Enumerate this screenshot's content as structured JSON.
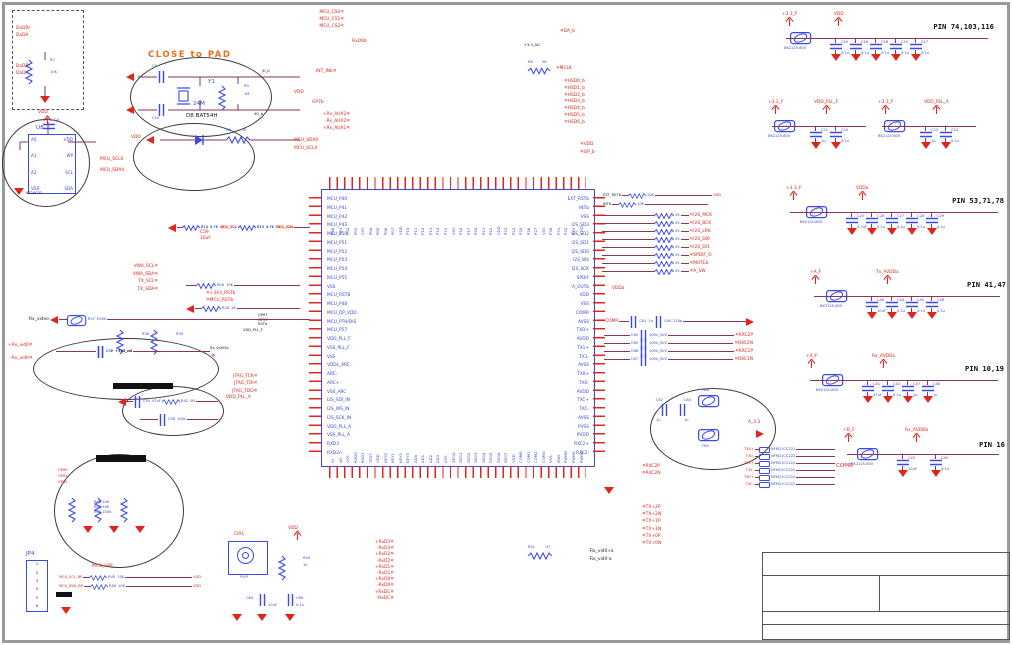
{
  "crystal_note": "CLOSE to PAD",
  "dashed_box": {
    "l1": "DaDR/",
    "l2": "DaDA",
    "l3": "DaDR/",
    "l4": "DaDA",
    "r_ref": "R7",
    "r_val": "10K"
  },
  "eeprom": {
    "ref": "U8",
    "part": "AT24C02",
    "vdd": "VDD",
    "cap_ref": "C4",
    "pins_left": [
      "A0",
      "A1",
      "A2",
      "VSS"
    ],
    "pins_right": [
      "VDD",
      "WP",
      "SCL",
      "SDA"
    ],
    "net1": "MCU_SCL0",
    "net2": "MCU_SDA0"
  },
  "crystal": {
    "ref": "Y1",
    "val": "24M",
    "c1": "C9",
    "c2": "C10",
    "r_ref": "R9",
    "r_val": "1M",
    "net_top": "XI_b",
    "net_bot": "XO_b"
  },
  "diode": {
    "label": "D8  BAT54H",
    "vdd": "VDD",
    "r_ref": "R8",
    "r_val": "1K"
  },
  "pullups": {
    "vdd": "VDD",
    "rows": [
      {
        "r1": "R12",
        "v1": "4.7K",
        "n1": "MCU_SCL",
        "r2": "R13",
        "v2": "4.7K",
        "n2": "MCU_SDA"
      },
      {
        "r1": "R14",
        "v1": "4.7K",
        "n1": "DDC_SCL",
        "r2": "R15",
        "v2": "4.7K",
        "n2": "DDC_SDA"
      }
    ]
  },
  "i2c_nets": [
    "VWA_SCL",
    "VWA_SDA",
    "TX_SCL",
    "TX_SDA"
  ],
  "c59": {
    "ref": "C59",
    "val": "10uF"
  },
  "reset": {
    "r26": "R26",
    "r26v": "10K",
    "net1": "+3V3_RSTb",
    "net2": "MCU_RSTb",
    "r28": "R28",
    "r28v": "1K",
    "gps": [
      "GP67",
      "GP57",
      "RSTb"
    ]
  },
  "pll": {
    "f": "VDD_PLL_F",
    "vid": "Rx_vid0Sa",
    "jtag": [
      "JTAG_TCK",
      "JTAG_TDI",
      "JTAG_TDO"
    ],
    "a": "VDD_PLL_A"
  },
  "left_pair": [
    "Rx_vid0+",
    "Rx_vid0-"
  ],
  "video_in": {
    "title": "Rx_video",
    "r_ref": "R37",
    "bead_val": "E560",
    "rows": [
      {
        "c": "C38",
        "net": "+3V3_vid"
      },
      {
        "c": "C37",
        "net": "+3V3_vid"
      }
    ],
    "r1": "R38",
    "r1v": "620",
    "r2": "R39",
    "r2v": "620"
  },
  "rc": {
    "c1": "C54",
    "c1v": "47uF",
    "r": "R42",
    "rv": "0R",
    "c2": "C58",
    "c2v": "100n"
  },
  "keys": {
    "nets": [
      "GP60",
      "GP61",
      "GP62"
    ],
    "res": [
      {
        "r": "R48",
        "v": "10K"
      },
      {
        "r": "R49",
        "v": "10K"
      },
      {
        "r": "R50",
        "v": "100K"
      }
    ]
  },
  "jp4": {
    "ref": "JP4",
    "pins": [
      "1",
      "2",
      "3",
      "4",
      "5",
      "6"
    ],
    "n0": "MCU_VPP",
    "n1": "MCU_SCL_BP",
    "n2": "MCU_SDA_BP",
    "r1": "R45",
    "r1v": "10K",
    "r2": "R46",
    "r2v": "10K",
    "vdd1": "VDD",
    "vdd2": "VDD"
  },
  "cir": {
    "ref": "CIR1",
    "sub": "PWR",
    "r_ref": "R40",
    "r_val": "1K",
    "vdd": "VDD",
    "c1": "C84",
    "c1v": "10uF",
    "c2": "C88",
    "c2v": "0.1u"
  },
  "ic": {
    "left_pins": [
      "MCU_P40",
      "MCU_P41",
      "MCU_P42",
      "MCU_P43",
      "MCU_P50",
      "MCU_P51",
      "MCU_P52",
      "MCU_P53",
      "MCU_P54",
      "MCU_P55",
      "VSS",
      "MCU_RSTB",
      "MCU_P48",
      "MCU_DP_VDD",
      "MCU_PTH/DIS",
      "MCU_P57",
      "VDD_PLL_F",
      "VSS_PLL_F",
      "VSS",
      "VDDL_ARC",
      "ARC-",
      "ARC+",
      "VSS_ARC",
      "I2S_SDI_IN",
      "I2S_WS_IN",
      "I2S_SCK_IN",
      "VDD_PLL_A",
      "VSS_PLL_A",
      "RXD3",
      "RXD2n"
    ],
    "right_pins": [
      "EXT_RSTb",
      "INTb",
      "VSS",
      "I2S_SD3",
      "I2S_SD2",
      "I2S_SD1",
      "I2S_SD0",
      "I2S_WS",
      "I2S_SCK",
      "SPDIF",
      "A_OUTb",
      "VDD",
      "VSS",
      "COMR",
      "AVSS",
      "TXD+",
      "AVDD",
      "TX1+",
      "TX1-",
      "AVSS",
      "TX0+",
      "TX0-",
      "AVDD",
      "TXC+",
      "TXC-",
      "AVSS",
      "PVSS",
      "PVDD",
      "RXC2+",
      "RXC2-"
    ],
    "top_pins": [
      "P00",
      "P01",
      "P02",
      "P03",
      "VSS",
      "P04",
      "P05",
      "P06",
      "P07",
      "VDD",
      "P10",
      "P11",
      "P12",
      "P13",
      "P14",
      "P15",
      "VSS",
      "P16",
      "P17",
      "P20",
      "P21",
      "P22",
      "VDD",
      "P23",
      "P24",
      "P25",
      "P26",
      "P27",
      "VSS",
      "P30",
      "P31",
      "P32",
      "P33",
      "VDD"
    ],
    "bottom_pins": [
      "XI",
      "XO",
      "VSS",
      "RXD0",
      "RXD1",
      "TEST",
      "VDD",
      "KEY0",
      "KEY1",
      "KEY2",
      "KEY3",
      "AD0",
      "AD1",
      "AD2",
      "AD3",
      "VSS",
      "SEG0",
      "SEG1",
      "SEG2",
      "SEG3",
      "SEG4",
      "SEG5",
      "SEG6",
      "SEG7",
      "VDD",
      "COM0",
      "COM1",
      "COM2",
      "COM3",
      "VSS",
      "IRIN",
      "PWM0",
      "PWM1",
      "PWM2"
    ]
  },
  "top_left_nets": [
    "MCU_CS0",
    "MCU_CS1",
    "MCU_CS2"
  ],
  "top_misc": {
    "rxd": "RxD0b",
    "int": "INT_INb",
    "vdd": "VDD",
    "gp": "GP7b",
    "ad": "+3.3_AD"
  },
  "top_aux": [
    "Rx_AUX2+",
    "Rx_AUX2-",
    "Rx_AUX1+"
  ],
  "top_i2c": [
    "MCU_SDA0",
    "MCU_SCL0"
  ],
  "top_right": {
    "da": "DA_b",
    "r6": "R6",
    "r6v": "56",
    "mclk": "MCLK",
    "hsd": [
      "HSD0_b",
      "HSD1_b",
      "HSD2_b",
      "HSD3_b",
      "HSD4_b",
      "HSD5_b",
      "HSD6_b"
    ],
    "vdd": "VDD",
    "gp": "GP_b"
  },
  "right_block": {
    "rst": {
      "n1": "EXT_RSTb",
      "r1": "R16",
      "v1": "10K",
      "n2": "INTb",
      "r2": "R17",
      "v2": "10K",
      "vdd": "VDD"
    },
    "rows": [
      {
        "r": "R18",
        "v": "33",
        "net": "I2S_MCK"
      },
      {
        "r": "R19",
        "v": "33",
        "net": "I2S_BCK"
      },
      {
        "r": "R20",
        "v": "33",
        "net": "I2S_LRK"
      },
      {
        "r": "R21",
        "v": "33",
        "net": "I2S_DI0"
      },
      {
        "r": "R22",
        "v": "33",
        "net": "I2S_DI1"
      },
      {
        "r": "R23",
        "v": "33",
        "net": "SPDIF_O"
      },
      {
        "r": "R24",
        "v": "33",
        "net": "MUTEb"
      },
      {
        "r": "R25",
        "v": "33",
        "net": "A_SW"
      }
    ],
    "vdda": "VDDa",
    "comr_row": {
      "net": "COMR",
      "c1": "C61",
      "c1v": "1u",
      "c2": "C60",
      "c2v": "220p"
    },
    "cap_rows": [
      {
        "c": "C64",
        "v": "100n_2kV",
        "net": "RXC2P"
      },
      {
        "c": "C65",
        "v": "100n_2kV",
        "net": "RXC2N"
      },
      {
        "c": "C66",
        "v": "100n_2kV",
        "net": "RXC1P"
      },
      {
        "c": "C67",
        "v": "100n_2kV",
        "net": "RXC1N"
      }
    ],
    "bead_ellipse": {
      "c1": "C62",
      "c1v": "1u",
      "c2": "C63",
      "c2v": "1u",
      "f1": "FB8",
      "f2": "FB9",
      "net": "A_3.3"
    },
    "emi": {
      "comr": "COMR",
      "rows": [
        {
          "net": "TX0+",
          "v": "NFM21CC222"
        },
        {
          "net": "TX0-",
          "v": "NFM21CC222"
        },
        {
          "net": "TX1+",
          "v": "NFM21CC222"
        },
        {
          "net": "TX1-",
          "v": "NFM21CC222"
        },
        {
          "net": "TXC+",
          "v": "NFM21CC222"
        },
        {
          "net": "TXC-",
          "v": "NFM21CC222"
        }
      ]
    }
  },
  "bottom": {
    "colA": [
      "RxD3+",
      "RxD3-",
      "RxD2+",
      "RxD2-",
      "RxD1+",
      "RxD1-",
      "RxD0+",
      "RxD0-",
      "RxDC+",
      "RxDC-"
    ],
    "pairB": [
      "RXC2P",
      "RXC2N"
    ],
    "colC": [
      "TX+2P",
      "TX+2N",
      "TX+1P",
      "TX+1N",
      "TX+0P",
      "TX+0N"
    ],
    "black_pair": [
      "Rx_vid0+a",
      "Rx_vid0-a"
    ],
    "r41": "R41",
    "r41v": "47"
  },
  "filters": [
    {
      "net1": "+3.3_F",
      "net2": "VDD",
      "pins": "PIN 74,103,116",
      "bead": "BK2125-600",
      "caps": [
        {
          "r": "C15",
          "v": "0.1u"
        },
        {
          "r": "C16",
          "v": "0.1u"
        },
        {
          "r": "C18",
          "v": "0.1u"
        },
        {
          "r": "C19",
          "v": "0.1u"
        },
        {
          "r": "C17",
          "v": "0.1u"
        }
      ]
    },
    {
      "net1": "+3.3_F",
      "net2": "VDD_PLL_F",
      "bead": "BK2125-600",
      "caps": [
        {
          "r": "C21",
          "v": "1u"
        },
        {
          "r": "C20",
          "v": "0.1u"
        }
      ]
    },
    {
      "net1": "+3.3_F",
      "net2": "VDD_PLL_A",
      "bead": "BK2125-600",
      "caps": [
        {
          "r": "C23",
          "v": "1u"
        },
        {
          "r": "C24",
          "v": "0.1u"
        }
      ]
    },
    {
      "net1": "+3.3_F",
      "net2": "VDDa",
      "pins": "PIN 53,71,78",
      "bead": "BK2125-600",
      "caps": [
        {
          "r": "C25",
          "v": "4.7uF"
        },
        {
          "r": "C26",
          "v": "0.1u"
        },
        {
          "r": "C27",
          "v": "0.1u"
        },
        {
          "r": "C28",
          "v": "0.1u"
        },
        {
          "r": "C29",
          "v": "0.1u"
        }
      ]
    },
    {
      "net1": "+A_F",
      "net2": "Tx_AVDDa",
      "pins": "PIN 41,47",
      "bead": "BK2125-600",
      "caps": [
        {
          "r": "C40",
          "v": "10uF"
        },
        {
          "r": "C44",
          "v": "0.1u"
        },
        {
          "r": "C45",
          "v": "0.1u"
        },
        {
          "r": "C46",
          "v": "0.1u"
        }
      ]
    },
    {
      "net1": "+A_F",
      "net2": "Rx_AVDDa",
      "pins": "PIN 10,19",
      "bead": "BK2125-600",
      "caps": [
        {
          "r": "C41",
          "v": "47uF"
        },
        {
          "r": "C42",
          "v": "0.1u"
        },
        {
          "r": "C47",
          "v": "1u"
        },
        {
          "r": "C48",
          "v": "1u"
        }
      ]
    },
    {
      "net1": "+D_F",
      "net2": "Rx_AVDDb",
      "pins": "PIN 16",
      "bead": "BK2125-600",
      "caps": [
        {
          "r": "C43",
          "v": "10uF"
        },
        {
          "r": "C49",
          "v": "0.1u"
        }
      ]
    }
  ]
}
